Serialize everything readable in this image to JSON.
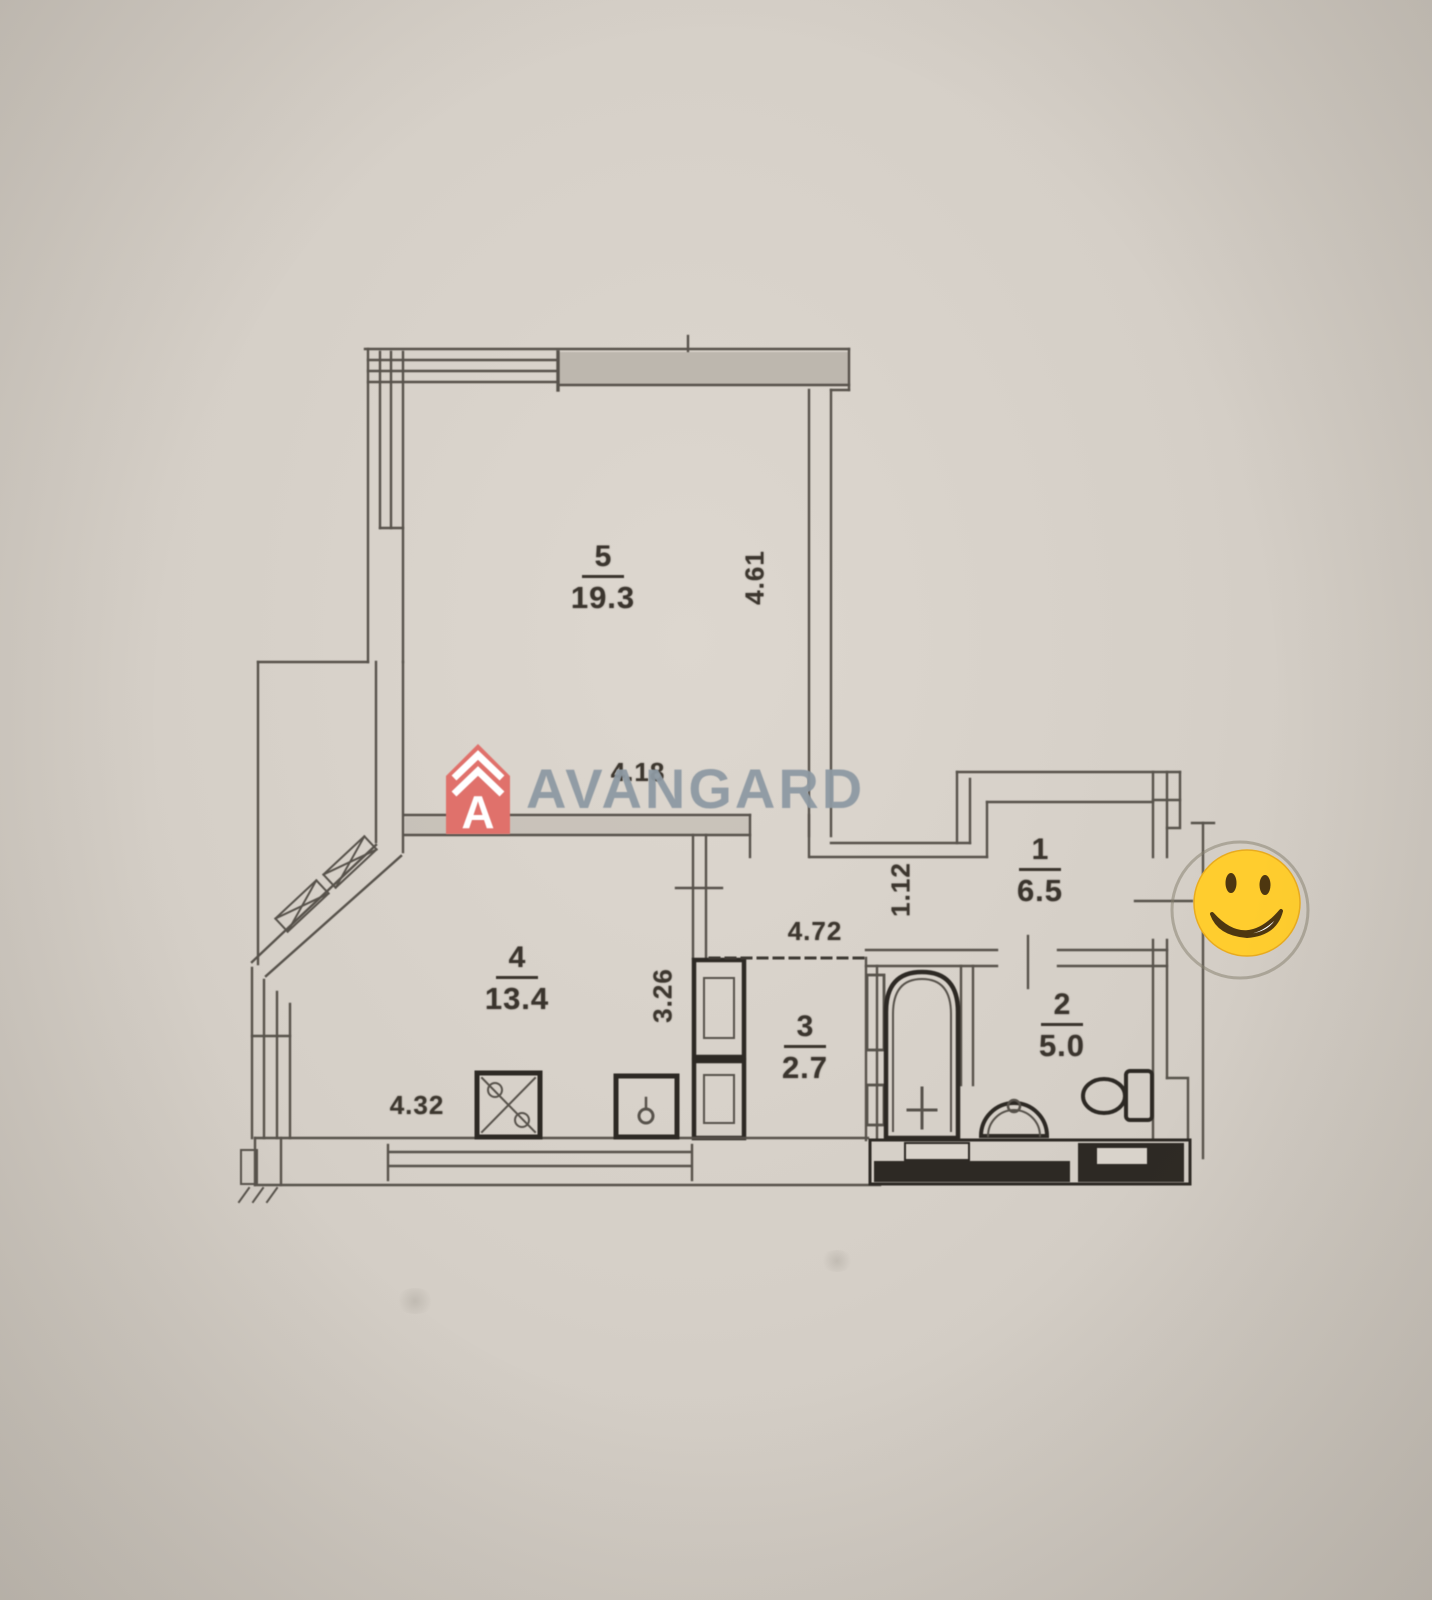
{
  "brand": {
    "name": "AVANGARD",
    "logo_letter": "A",
    "logo_color": "#e0716b",
    "text_color": "#8e99a3"
  },
  "sticker": {
    "name": "smiley-emoji",
    "face_color": "#ffcd2e"
  },
  "rooms": [
    {
      "id": "5",
      "area": "19.3"
    },
    {
      "id": "4",
      "area": "13.4"
    },
    {
      "id": "3",
      "area": "2.7"
    },
    {
      "id": "2",
      "area": "5.0"
    },
    {
      "id": "1",
      "area": "6.5"
    }
  ],
  "dimensions": [
    {
      "value": "4.61",
      "orientation": "vertical"
    },
    {
      "value": "4.18",
      "orientation": "horizontal"
    },
    {
      "value": "4.72",
      "orientation": "horizontal"
    },
    {
      "value": "1.12",
      "orientation": "vertical"
    },
    {
      "value": "3.26",
      "orientation": "vertical"
    },
    {
      "value": "4.32",
      "orientation": "horizontal"
    }
  ]
}
